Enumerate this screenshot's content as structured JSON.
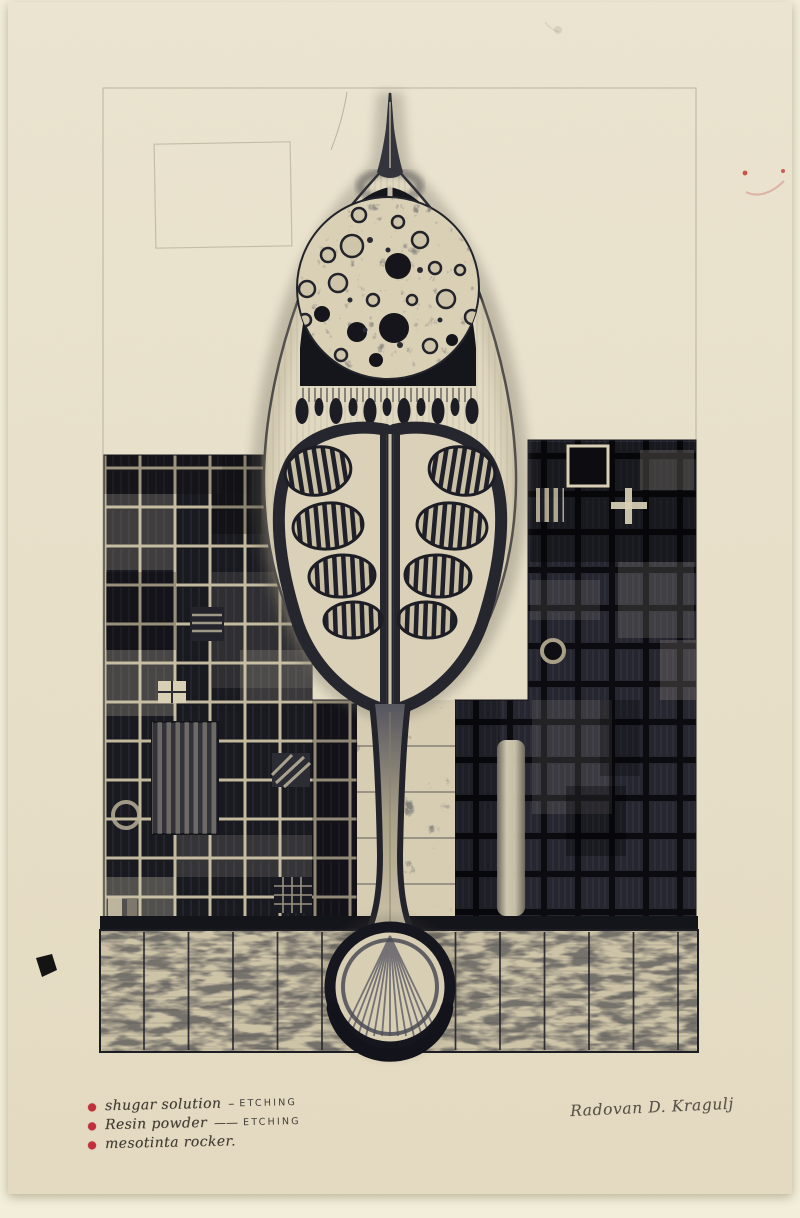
{
  "annotations": {
    "items": [
      {
        "label": "shugar solution",
        "connector": "–",
        "technique": "ETCHING"
      },
      {
        "label": "Resin powder",
        "connector": "——",
        "technique": "ETCHING"
      },
      {
        "label": "mesotinta rocker.",
        "connector": "",
        "technique": ""
      }
    ]
  },
  "signature": {
    "text": "Radovan D. Kragulj"
  },
  "colors": {
    "scan_background": "#f2eeda",
    "paper": "#e9e1cb",
    "ink": "#1b1b22",
    "bullet_red": "#c22f3c"
  }
}
